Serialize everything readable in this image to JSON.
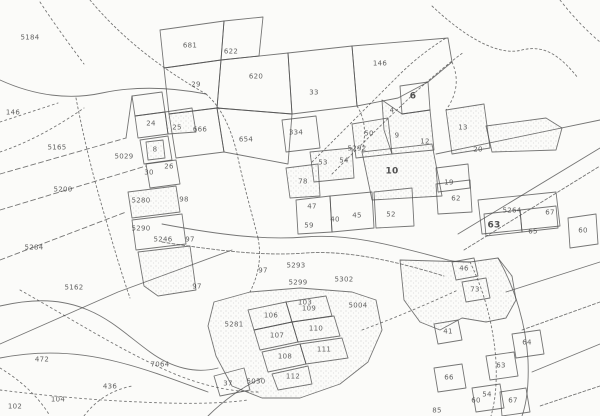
{
  "map": {
    "kind": "scanned cadastral parcel map",
    "paper_color": "#fbfbf9",
    "ink_color": "#4f4f4f",
    "labels": [
      {
        "text": "5184",
        "x": 30,
        "y": 38
      },
      {
        "text": "146",
        "x": 13,
        "y": 113
      },
      {
        "text": "5165",
        "x": 57,
        "y": 148
      },
      {
        "text": "5200",
        "x": 63,
        "y": 190
      },
      {
        "text": "5284",
        "x": 34,
        "y": 248
      },
      {
        "text": "5162",
        "x": 74,
        "y": 288
      },
      {
        "text": "472",
        "x": 42,
        "y": 360
      },
      {
        "text": "7064",
        "x": 160,
        "y": 365
      },
      {
        "text": "436",
        "x": 110,
        "y": 387
      },
      {
        "text": "104",
        "x": 58,
        "y": 400
      },
      {
        "text": "102",
        "x": 15,
        "y": 407
      },
      {
        "text": "681",
        "x": 190,
        "y": 46
      },
      {
        "text": "622",
        "x": 231,
        "y": 52
      },
      {
        "text": "29",
        "x": 196,
        "y": 85
      },
      {
        "text": "620",
        "x": 256,
        "y": 77
      },
      {
        "text": "33",
        "x": 314,
        "y": 93
      },
      {
        "text": "666",
        "x": 200,
        "y": 130
      },
      {
        "text": "654",
        "x": 246,
        "y": 140
      },
      {
        "text": "146",
        "x": 380,
        "y": 64
      },
      {
        "text": "24",
        "x": 151,
        "y": 124
      },
      {
        "text": "25",
        "x": 177,
        "y": 128
      },
      {
        "text": "8",
        "x": 155,
        "y": 150
      },
      {
        "text": "26",
        "x": 169,
        "y": 167
      },
      {
        "text": "30",
        "x": 149,
        "y": 173
      },
      {
        "text": "5029",
        "x": 124,
        "y": 157
      },
      {
        "text": "5280",
        "x": 141,
        "y": 201
      },
      {
        "text": "98",
        "x": 184,
        "y": 200
      },
      {
        "text": "5290",
        "x": 141,
        "y": 229
      },
      {
        "text": "5246",
        "x": 163,
        "y": 240
      },
      {
        "text": "97",
        "x": 190,
        "y": 240
      },
      {
        "text": "97",
        "x": 197,
        "y": 287
      },
      {
        "text": "334",
        "x": 296,
        "y": 133
      },
      {
        "text": "50",
        "x": 369,
        "y": 134
      },
      {
        "text": "5292",
        "x": 357,
        "y": 149
      },
      {
        "text": "9",
        "x": 397,
        "y": 136
      },
      {
        "text": "53",
        "x": 323,
        "y": 163
      },
      {
        "text": "54",
        "x": 344,
        "y": 161
      },
      {
        "text": "10",
        "x": 392,
        "y": 172,
        "bold": true
      },
      {
        "text": "78",
        "x": 303,
        "y": 182
      },
      {
        "text": "47",
        "x": 312,
        "y": 207
      },
      {
        "text": "59",
        "x": 309,
        "y": 226
      },
      {
        "text": "40",
        "x": 335,
        "y": 220
      },
      {
        "text": "45",
        "x": 357,
        "y": 216
      },
      {
        "text": "52",
        "x": 391,
        "y": 215
      },
      {
        "text": "6",
        "x": 413,
        "y": 97,
        "bold": true
      },
      {
        "text": "4",
        "x": 392,
        "y": 111
      },
      {
        "text": "13",
        "x": 463,
        "y": 128
      },
      {
        "text": "12",
        "x": 425,
        "y": 142
      },
      {
        "text": "20",
        "x": 478,
        "y": 150
      },
      {
        "text": "19",
        "x": 449,
        "y": 183
      },
      {
        "text": "62",
        "x": 456,
        "y": 199
      },
      {
        "text": "5264",
        "x": 512,
        "y": 211
      },
      {
        "text": "63",
        "x": 494,
        "y": 226,
        "bold": true
      },
      {
        "text": "65",
        "x": 533,
        "y": 232
      },
      {
        "text": "67",
        "x": 550,
        "y": 213
      },
      {
        "text": "60",
        "x": 583,
        "y": 231
      },
      {
        "text": "5293",
        "x": 296,
        "y": 266
      },
      {
        "text": "97",
        "x": 263,
        "y": 271
      },
      {
        "text": "5299",
        "x": 298,
        "y": 283
      },
      {
        "text": "5302",
        "x": 344,
        "y": 280
      },
      {
        "text": "103",
        "x": 305,
        "y": 303
      },
      {
        "text": "5004",
        "x": 358,
        "y": 306
      },
      {
        "text": "5281",
        "x": 234,
        "y": 325
      },
      {
        "text": "106",
        "x": 271,
        "y": 316
      },
      {
        "text": "109",
        "x": 309,
        "y": 309
      },
      {
        "text": "107",
        "x": 277,
        "y": 336
      },
      {
        "text": "110",
        "x": 316,
        "y": 329
      },
      {
        "text": "108",
        "x": 285,
        "y": 357
      },
      {
        "text": "111",
        "x": 324,
        "y": 350
      },
      {
        "text": "112",
        "x": 293,
        "y": 377
      },
      {
        "text": "5030",
        "x": 256,
        "y": 382
      },
      {
        "text": "37",
        "x": 228,
        "y": 384
      },
      {
        "text": "46",
        "x": 464,
        "y": 269
      },
      {
        "text": "73",
        "x": 475,
        "y": 290
      },
      {
        "text": "41",
        "x": 448,
        "y": 332
      },
      {
        "text": "64",
        "x": 527,
        "y": 343
      },
      {
        "text": "63",
        "x": 501,
        "y": 366
      },
      {
        "text": "66",
        "x": 449,
        "y": 378
      },
      {
        "text": "54",
        "x": 487,
        "y": 395
      },
      {
        "text": "60",
        "x": 476,
        "y": 401
      },
      {
        "text": "67",
        "x": 513,
        "y": 401
      },
      {
        "text": "85",
        "x": 437,
        "y": 411
      }
    ],
    "polygons": [
      {
        "points": "160,30 224,21 221,60 164,68",
        "fill": "n"
      },
      {
        "points": "224,21 263,17 259,56 221,60",
        "fill": "n"
      },
      {
        "points": "164,68 221,60 217,108 169,114",
        "fill": "n"
      },
      {
        "points": "221,60 288,53 292,114 217,108",
        "fill": "n"
      },
      {
        "points": "288,53 352,46 357,106 292,114",
        "fill": "n"
      },
      {
        "points": "352,46 448,38 452,62 428,82 398,98 357,106",
        "fill": "n"
      },
      {
        "points": "217,108 292,114 288,164 224,152",
        "fill": "n"
      },
      {
        "points": "169,114 217,108 224,152 176,158",
        "fill": "n"
      },
      {
        "points": "132,96 162,92 165,112 135,116",
        "fill": "n"
      },
      {
        "points": "135,116 165,112 168,134 138,138",
        "fill": "n"
      },
      {
        "points": "165,112 192,108 196,132 168,134",
        "fill": "s"
      },
      {
        "points": "140,140 168,136 172,160 144,164",
        "fill": "n"
      },
      {
        "points": "146,142 163,140 165,158 148,160",
        "fill": "s"
      },
      {
        "points": "146,164 176,160 180,184 150,188",
        "fill": "n"
      },
      {
        "points": "128,192 176,186 180,212 132,218",
        "fill": "s"
      },
      {
        "points": "132,220 182,214 186,244 136,250",
        "fill": "n"
      },
      {
        "points": "138,252 190,246 196,290 158,296 144,286",
        "fill": "s"
      },
      {
        "points": "282,120 316,116 320,148 286,152",
        "fill": "n"
      },
      {
        "points": "352,124 388,118 392,154 356,158",
        "fill": "s"
      },
      {
        "points": "310,152 352,148 354,178 314,182",
        "fill": "s"
      },
      {
        "points": "362,152 432,144 442,196 372,200",
        "fill": "s"
      },
      {
        "points": "286,168 318,164 320,196 290,198",
        "fill": "s"
      },
      {
        "points": "296,200 330,196 332,232 298,234",
        "fill": "n"
      },
      {
        "points": "330,196 372,192 374,228 332,232",
        "fill": "n"
      },
      {
        "points": "374,192 412,188 414,226 376,228",
        "fill": "n"
      },
      {
        "points": "436,184 470,180 472,212 438,214",
        "fill": "n"
      },
      {
        "points": "400,86 428,82 430,110 402,114",
        "fill": "n"
      },
      {
        "points": "382,100 402,114 430,110 434,150 392,154 384,130",
        "fill": "s"
      },
      {
        "points": "446,110 484,104 490,148 452,154",
        "fill": "s"
      },
      {
        "points": "436,168 468,164 470,188 438,192",
        "fill": "n"
      },
      {
        "points": "486,126 546,118 562,128 556,150 492,152",
        "fill": "s"
      },
      {
        "points": "478,200 556,192 560,226 482,234",
        "fill": "n"
      },
      {
        "points": "568,218 596,214 598,244 570,248",
        "fill": "n"
      },
      {
        "points": "484,214 520,210 522,232 486,236",
        "fill": "n"
      },
      {
        "points": "520,210 556,206 558,228 522,232",
        "fill": "n"
      },
      {
        "points": "214,302 250,292 300,288 352,292 376,300 382,330 368,362 340,384 300,398 262,398 232,386 216,356 208,326",
        "fill": "s"
      },
      {
        "points": "248,310 286,302 292,322 254,330",
        "fill": "n"
      },
      {
        "points": "286,302 326,296 332,316 292,322",
        "fill": "n"
      },
      {
        "points": "254,330 292,322 298,342 260,350",
        "fill": "n"
      },
      {
        "points": "292,322 334,316 340,336 298,342",
        "fill": "n"
      },
      {
        "points": "262,352 300,344 306,364 268,372",
        "fill": "n"
      },
      {
        "points": "300,344 342,338 348,358 306,364",
        "fill": "n"
      },
      {
        "points": "272,374 308,366 312,384 278,390",
        "fill": "n"
      },
      {
        "points": "214,376 244,368 250,390 220,396",
        "fill": "n"
      },
      {
        "points": "400,260 470,262 498,258 512,276 516,300 506,318 486,322 462,318 440,330 420,322 404,300",
        "fill": "s"
      },
      {
        "points": "452,262 474,258 478,276 456,280",
        "fill": "n"
      },
      {
        "points": "462,282 486,278 490,298 466,302",
        "fill": "n"
      },
      {
        "points": "434,324 458,320 462,340 438,344",
        "fill": "n"
      },
      {
        "points": "512,334 540,330 544,354 516,358",
        "fill": "n"
      },
      {
        "points": "486,356 514,352 518,376 490,380",
        "fill": "n"
      },
      {
        "points": "434,368 462,364 466,388 438,392",
        "fill": "n"
      },
      {
        "points": "472,388 500,384 504,408 476,412",
        "fill": "n"
      },
      {
        "points": "500,392 526,388 530,412 502,416",
        "fill": "n"
      }
    ],
    "roads": [
      {
        "d": "M 90,0 C 115,30 150,62 206,94",
        "dash": "2 2.5"
      },
      {
        "d": "M 40,2 C 55,25 70,45 84,64",
        "dash": "2 3"
      },
      {
        "d": "M 0,80 C 35,96 70,100 102,93 C 140,85 175,88 206,94",
        "dash": "none"
      },
      {
        "d": "M 206,94 C 222,108 232,130 238,158 C 244,186 252,214 258,238",
        "dash": "2 2.5"
      },
      {
        "d": "M 0,122 L 58,103",
        "dash": "2 3"
      },
      {
        "d": "M 0,152 C 30,142 58,126 84,108",
        "dash": "2 3"
      },
      {
        "d": "M 0,174 L 126,138",
        "dash": "5 3"
      },
      {
        "d": "M 0,210 L 146,166",
        "dash": "5 3"
      },
      {
        "d": "M 0,260 L 126,212",
        "dash": "5 3"
      },
      {
        "d": "M 0,344 L 118,292 L 232,250",
        "dash": "none"
      },
      {
        "d": "M 76,98 C 84,140 94,180 106,220 C 114,248 122,275 130,298",
        "dash": "2 2.5"
      },
      {
        "d": "M 432,6 C 468,40 500,56 522,50 C 546,44 562,58 578,78",
        "dash": "2 2.5"
      },
      {
        "d": "M 560,0 C 574,18 588,32 600,42",
        "dash": "2 3"
      },
      {
        "d": "M 162,224 C 225,236 268,240 305,237 C 350,233 395,246 448,260",
        "dash": "none"
      },
      {
        "d": "M 162,242 C 225,252 268,256 305,253 C 350,250 398,262 444,276",
        "dash": "3 2"
      },
      {
        "d": "M 312,162 C 342,132 372,102 398,76 C 414,60 430,48 446,38",
        "dash": "2 2.5"
      },
      {
        "d": "M 332,174 C 362,144 392,114 420,88 C 436,74 450,62 464,52",
        "dash": "2 2.5"
      },
      {
        "d": "M 458,234 L 600,148",
        "dash": "none"
      },
      {
        "d": "M 464,250 L 600,166",
        "dash": "3 2"
      },
      {
        "d": "M 498,258 C 516,290 526,326 528,360 C 529,385 527,402 522,416",
        "dash": "none"
      },
      {
        "d": "M 470,262 C 486,295 494,330 496,362 C 497,385 495,402 491,416",
        "dash": "2 2.5"
      },
      {
        "d": "M 0,306 C 35,298 62,299 88,310 C 112,320 128,336 150,352 C 172,368 196,374 218,368",
        "dash": "none"
      },
      {
        "d": "M 20,290 C 70,318 120,350 170,372 C 200,385 230,392 258,392",
        "dash": "2 3"
      },
      {
        "d": "M 0,358 C 40,350 80,352 118,362 C 150,370 180,382 208,392",
        "dash": "none"
      },
      {
        "d": "M 0,390 C 40,395 90,400 140,402 C 180,404 220,404 248,400",
        "dash": "2 3"
      },
      {
        "d": "M 208,416 C 224,400 244,386 262,378",
        "dash": "none"
      },
      {
        "d": "M 362,330 C 400,316 432,302 458,290",
        "dash": "2 3"
      },
      {
        "d": "M 600,120 L 436,154",
        "dash": "none"
      },
      {
        "d": "M 600,262 L 506,292",
        "dash": "none"
      },
      {
        "d": "M 600,302 L 522,330",
        "dash": "3 2"
      },
      {
        "d": "M 600,344 L 532,372",
        "dash": "none"
      },
      {
        "d": "M 600,386 L 540,406",
        "dash": "3 2"
      },
      {
        "d": "M 0,368 C 20,380 38,396 50,416",
        "dash": "2 3"
      },
      {
        "d": "M 84,416 C 96,400 112,390 132,386",
        "dash": "2 3"
      },
      {
        "d": "M 126,138 L 132,96",
        "dash": "none"
      },
      {
        "d": "M 258,238 C 262,258 258,276 250,292",
        "dash": "2 2.5"
      },
      {
        "d": "M 357,106 C 366,120 366,136 362,152",
        "dash": "2 2.5"
      },
      {
        "d": "M 452,62 C 460,80 456,96 446,110",
        "dash": "2 3"
      },
      {
        "d": "M 448,260 C 456,262 464,262 470,262",
        "dash": "none"
      }
    ]
  }
}
